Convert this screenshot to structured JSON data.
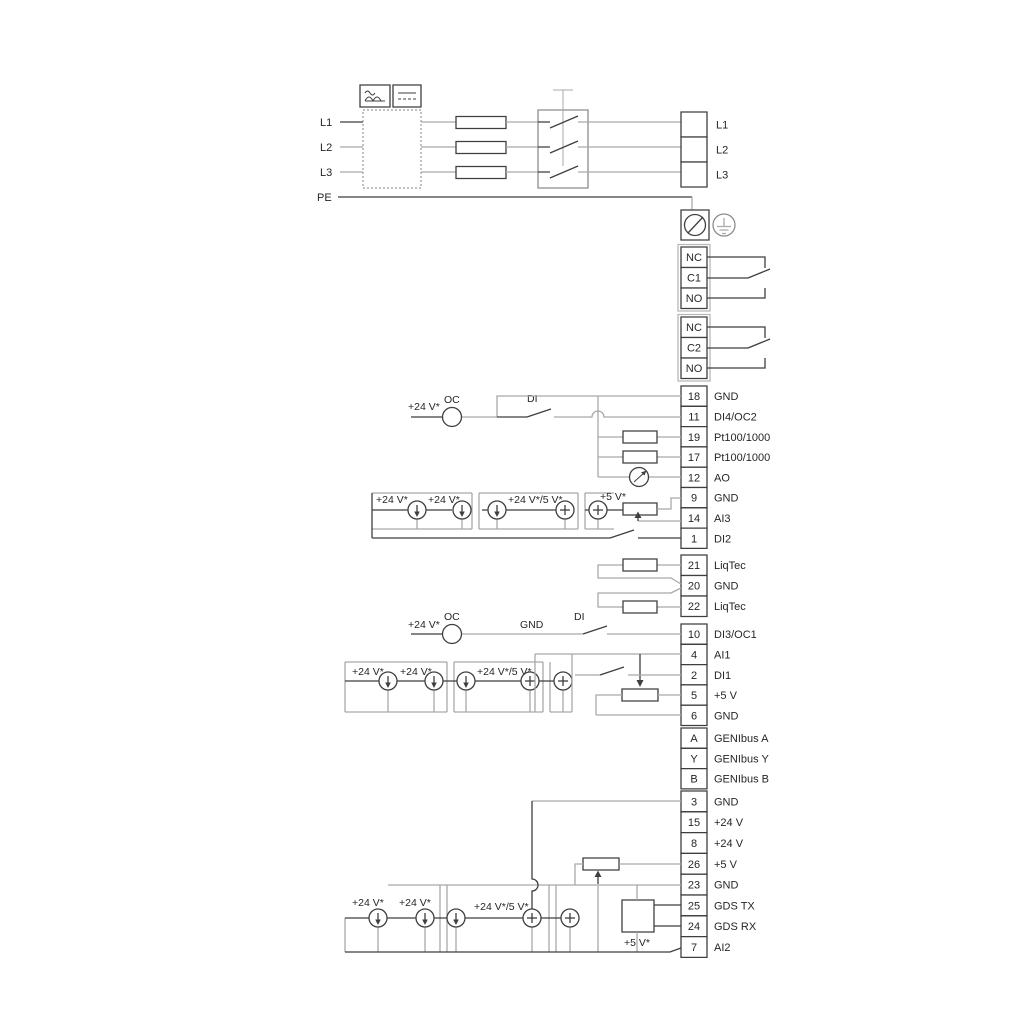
{
  "colors": {
    "dark": "#3f3f3f",
    "gray": "#a9a9a9",
    "text": "#262626",
    "bg": "#ffffff"
  },
  "power_in": {
    "l1": "L1",
    "l2": "L2",
    "l3": "L3",
    "pe": "PE"
  },
  "power_out": {
    "l1": "L1",
    "l2": "L2",
    "l3": "L3"
  },
  "relay1": {
    "rows": [
      {
        "label": "NC"
      },
      {
        "label": "C1"
      },
      {
        "label": "NO"
      }
    ]
  },
  "relay2": {
    "rows": [
      {
        "label": "NC"
      },
      {
        "label": "C2"
      },
      {
        "label": "NO"
      }
    ]
  },
  "io1": {
    "rows": [
      {
        "num": "18",
        "label": "GND"
      },
      {
        "num": "11",
        "label": "DI4/OC2"
      },
      {
        "num": "19",
        "label": "Pt100/1000"
      },
      {
        "num": "17",
        "label": "Pt100/1000"
      },
      {
        "num": "12",
        "label": "AO"
      },
      {
        "num": "9",
        "label": "GND"
      },
      {
        "num": "14",
        "label": "AI3"
      },
      {
        "num": "1",
        "label": "DI2"
      }
    ]
  },
  "liqtec": {
    "rows": [
      {
        "num": "21",
        "label": "LiqTec"
      },
      {
        "num": "20",
        "label": "GND"
      },
      {
        "num": "22",
        "label": "LiqTec"
      }
    ]
  },
  "io2": {
    "rows": [
      {
        "num": "10",
        "label": "DI3/OC1"
      },
      {
        "num": "4",
        "label": "AI1"
      },
      {
        "num": "2",
        "label": "DI1"
      },
      {
        "num": "5",
        "label": "+5 V"
      },
      {
        "num": "6",
        "label": "GND"
      },
      {
        "num": "A",
        "label": "GENIbus A"
      },
      {
        "num": "Y",
        "label": "GENIbus Y"
      },
      {
        "num": "B",
        "label": "GENIbus B"
      }
    ]
  },
  "io3": {
    "rows": [
      {
        "num": "3",
        "label": "GND"
      },
      {
        "num": "15",
        "label": "+24 V"
      },
      {
        "num": "8",
        "label": "+24 V"
      },
      {
        "num": "26",
        "label": "+5 V"
      },
      {
        "num": "23",
        "label": "GND"
      },
      {
        "num": "25",
        "label": "GDS TX"
      },
      {
        "num": "24",
        "label": "GDS RX"
      },
      {
        "num": "7",
        "label": "AI2"
      }
    ]
  },
  "ann": {
    "di4": {
      "v24": "+24 V*",
      "oc": "OC",
      "di": "DI"
    },
    "ai3": {
      "v24a": "+24 V*",
      "v24b": "+24 V*",
      "v24_5": "+24 V*/5 V*",
      "v5": "+5 V*"
    },
    "di3": {
      "v24": "+24 V*",
      "oc": "OC",
      "gnd": "GND",
      "di": "DI"
    },
    "ai1": {
      "v24a": "+24 V*",
      "v24b": "+24 V*",
      "v24_5": "+24 V*/5 V*"
    },
    "ai2": {
      "v24a": "+24 V*",
      "v24b": "+24 V*",
      "v24_5": "+24 V*/5 V*",
      "v5": "+5 V*"
    }
  }
}
